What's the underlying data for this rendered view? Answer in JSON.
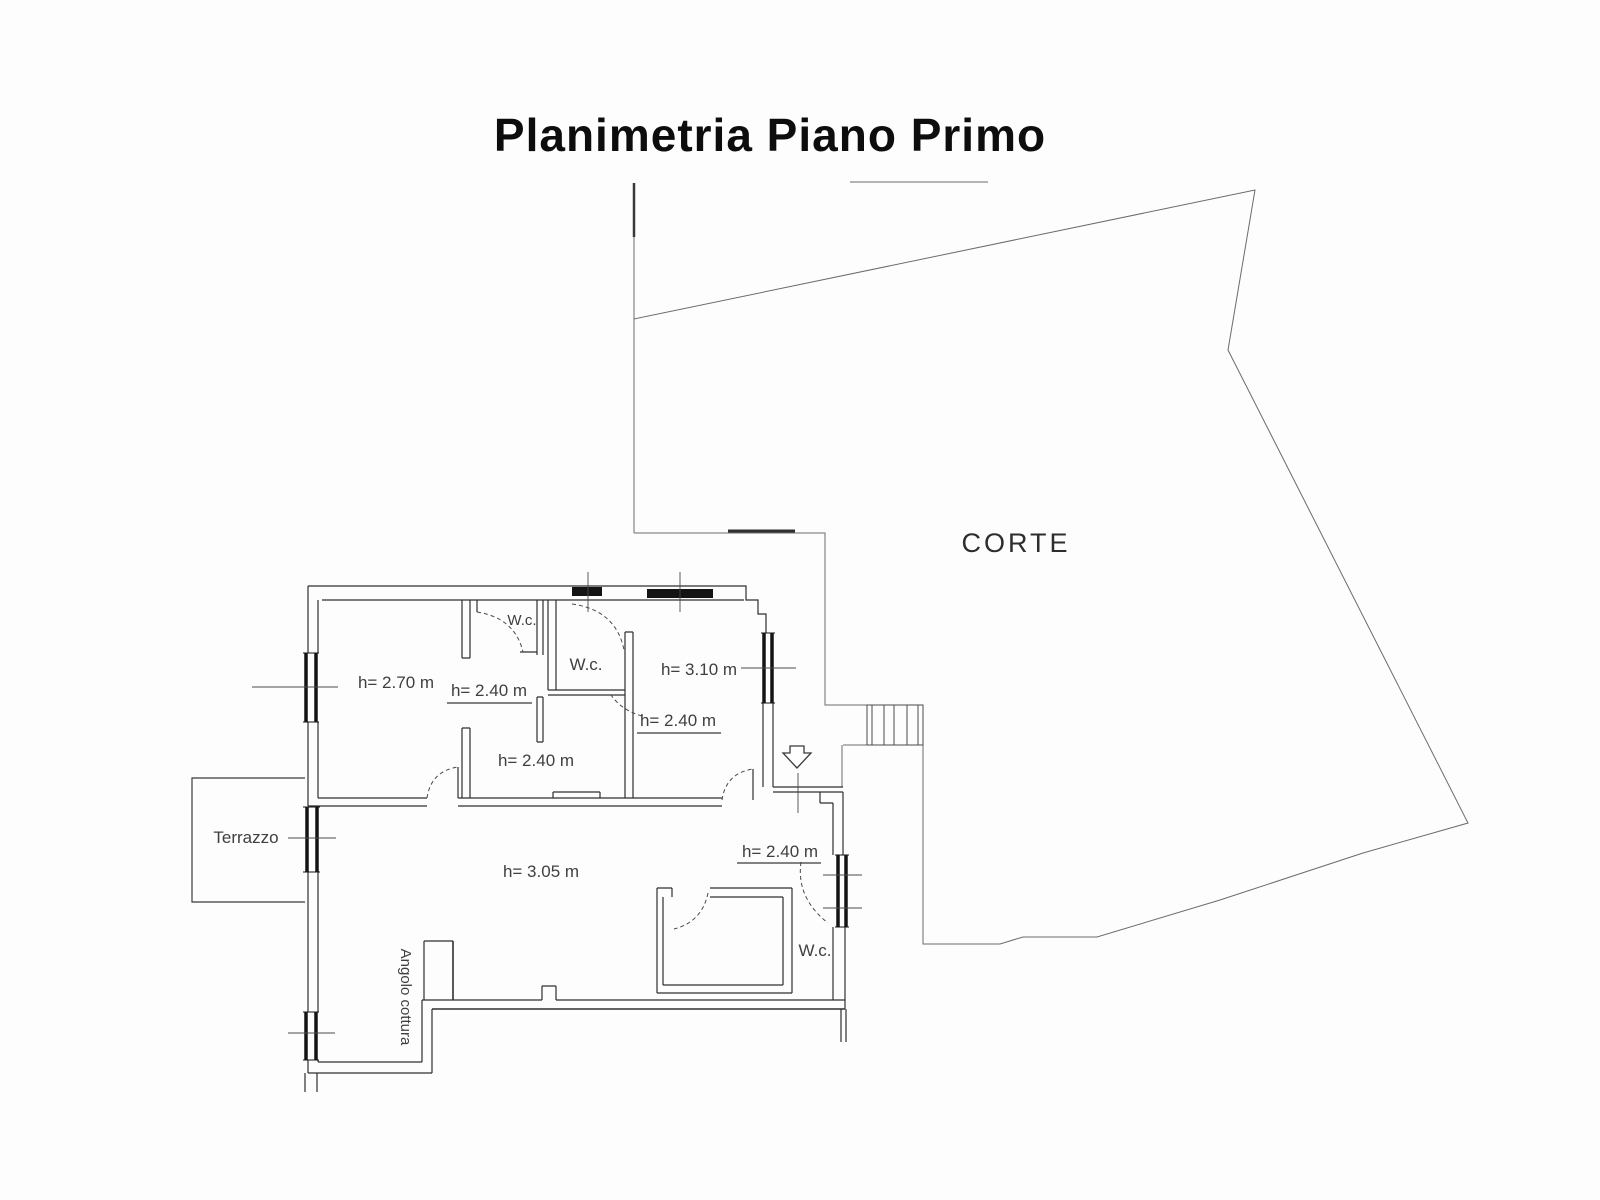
{
  "title": "Planimetria Piano Primo",
  "courtyard": {
    "label": "CORTE"
  },
  "terrace": {
    "label": "Terrazzo"
  },
  "kitchenette": {
    "label": "Angolo cottura"
  },
  "rooms": {
    "room_h270": "h= 2.70 m",
    "hall_h240_top": "h= 2.40 m",
    "wc_top": "W.c.",
    "wc_middle": "W.c.",
    "room_h310": "h= 3.10 m",
    "room_h240_right": "h= 2.40 m",
    "hall_h240_center": "h= 2.40 m",
    "living_h305": "h= 3.05 m",
    "corridor_h240_bottom": "h= 2.40 m",
    "wc_bottom": "W.c."
  }
}
